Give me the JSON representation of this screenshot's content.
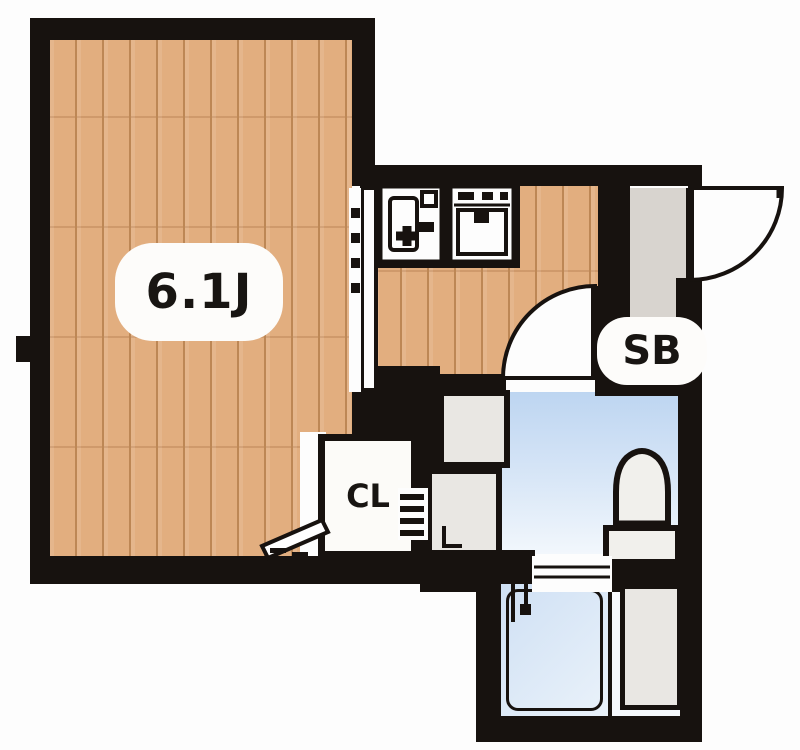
{
  "floorplan": {
    "labels": {
      "main_room": "6.1J",
      "shoe_box": "SB",
      "closet": "CL"
    },
    "colors": {
      "wall": "#17120f",
      "wood": "#e2ae7f",
      "woodline": "#bd8755",
      "bathblue1": "#bdd5f1",
      "bathblue2": "#f2f7fc",
      "tubblue1": "#cfe0f4",
      "tubblue2": "#eaf2fa",
      "genkan": "#d8d4cf",
      "fixture": "#e9e7e3",
      "paper": "#fdfdfd",
      "ink": "#181512"
    }
  }
}
